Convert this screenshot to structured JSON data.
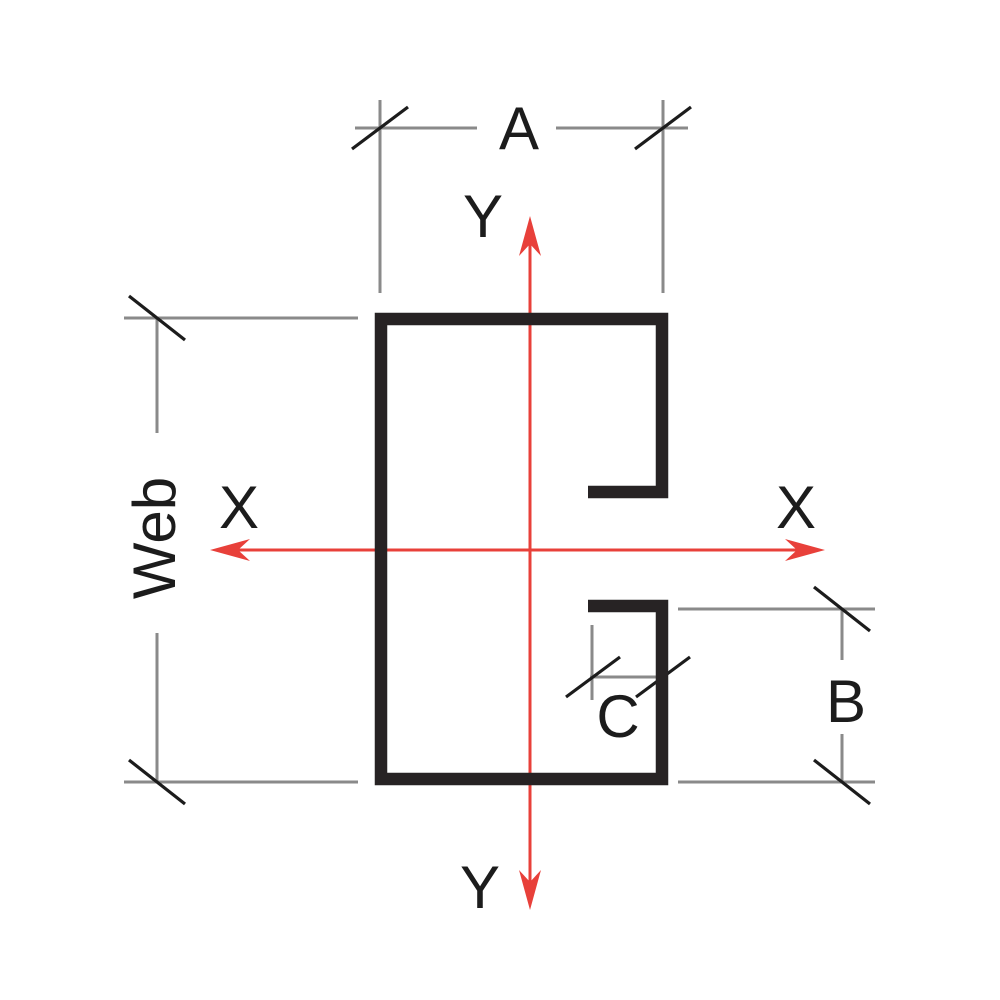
{
  "diagram": {
    "section_labels": {
      "a": "A",
      "b": "B",
      "c": "C",
      "web": "Web"
    },
    "axis_labels": {
      "x_left": "X",
      "x_right": "X",
      "y_top": "Y",
      "y_bottom": "Y"
    },
    "colors": {
      "section_outline": "#272324",
      "dimension_lines": "#8a8a8a",
      "tick_marks": "#1c1c1c",
      "axis_lines": "#e8403a",
      "label_text": "#1c1c1c",
      "background": "#ffffff"
    }
  }
}
